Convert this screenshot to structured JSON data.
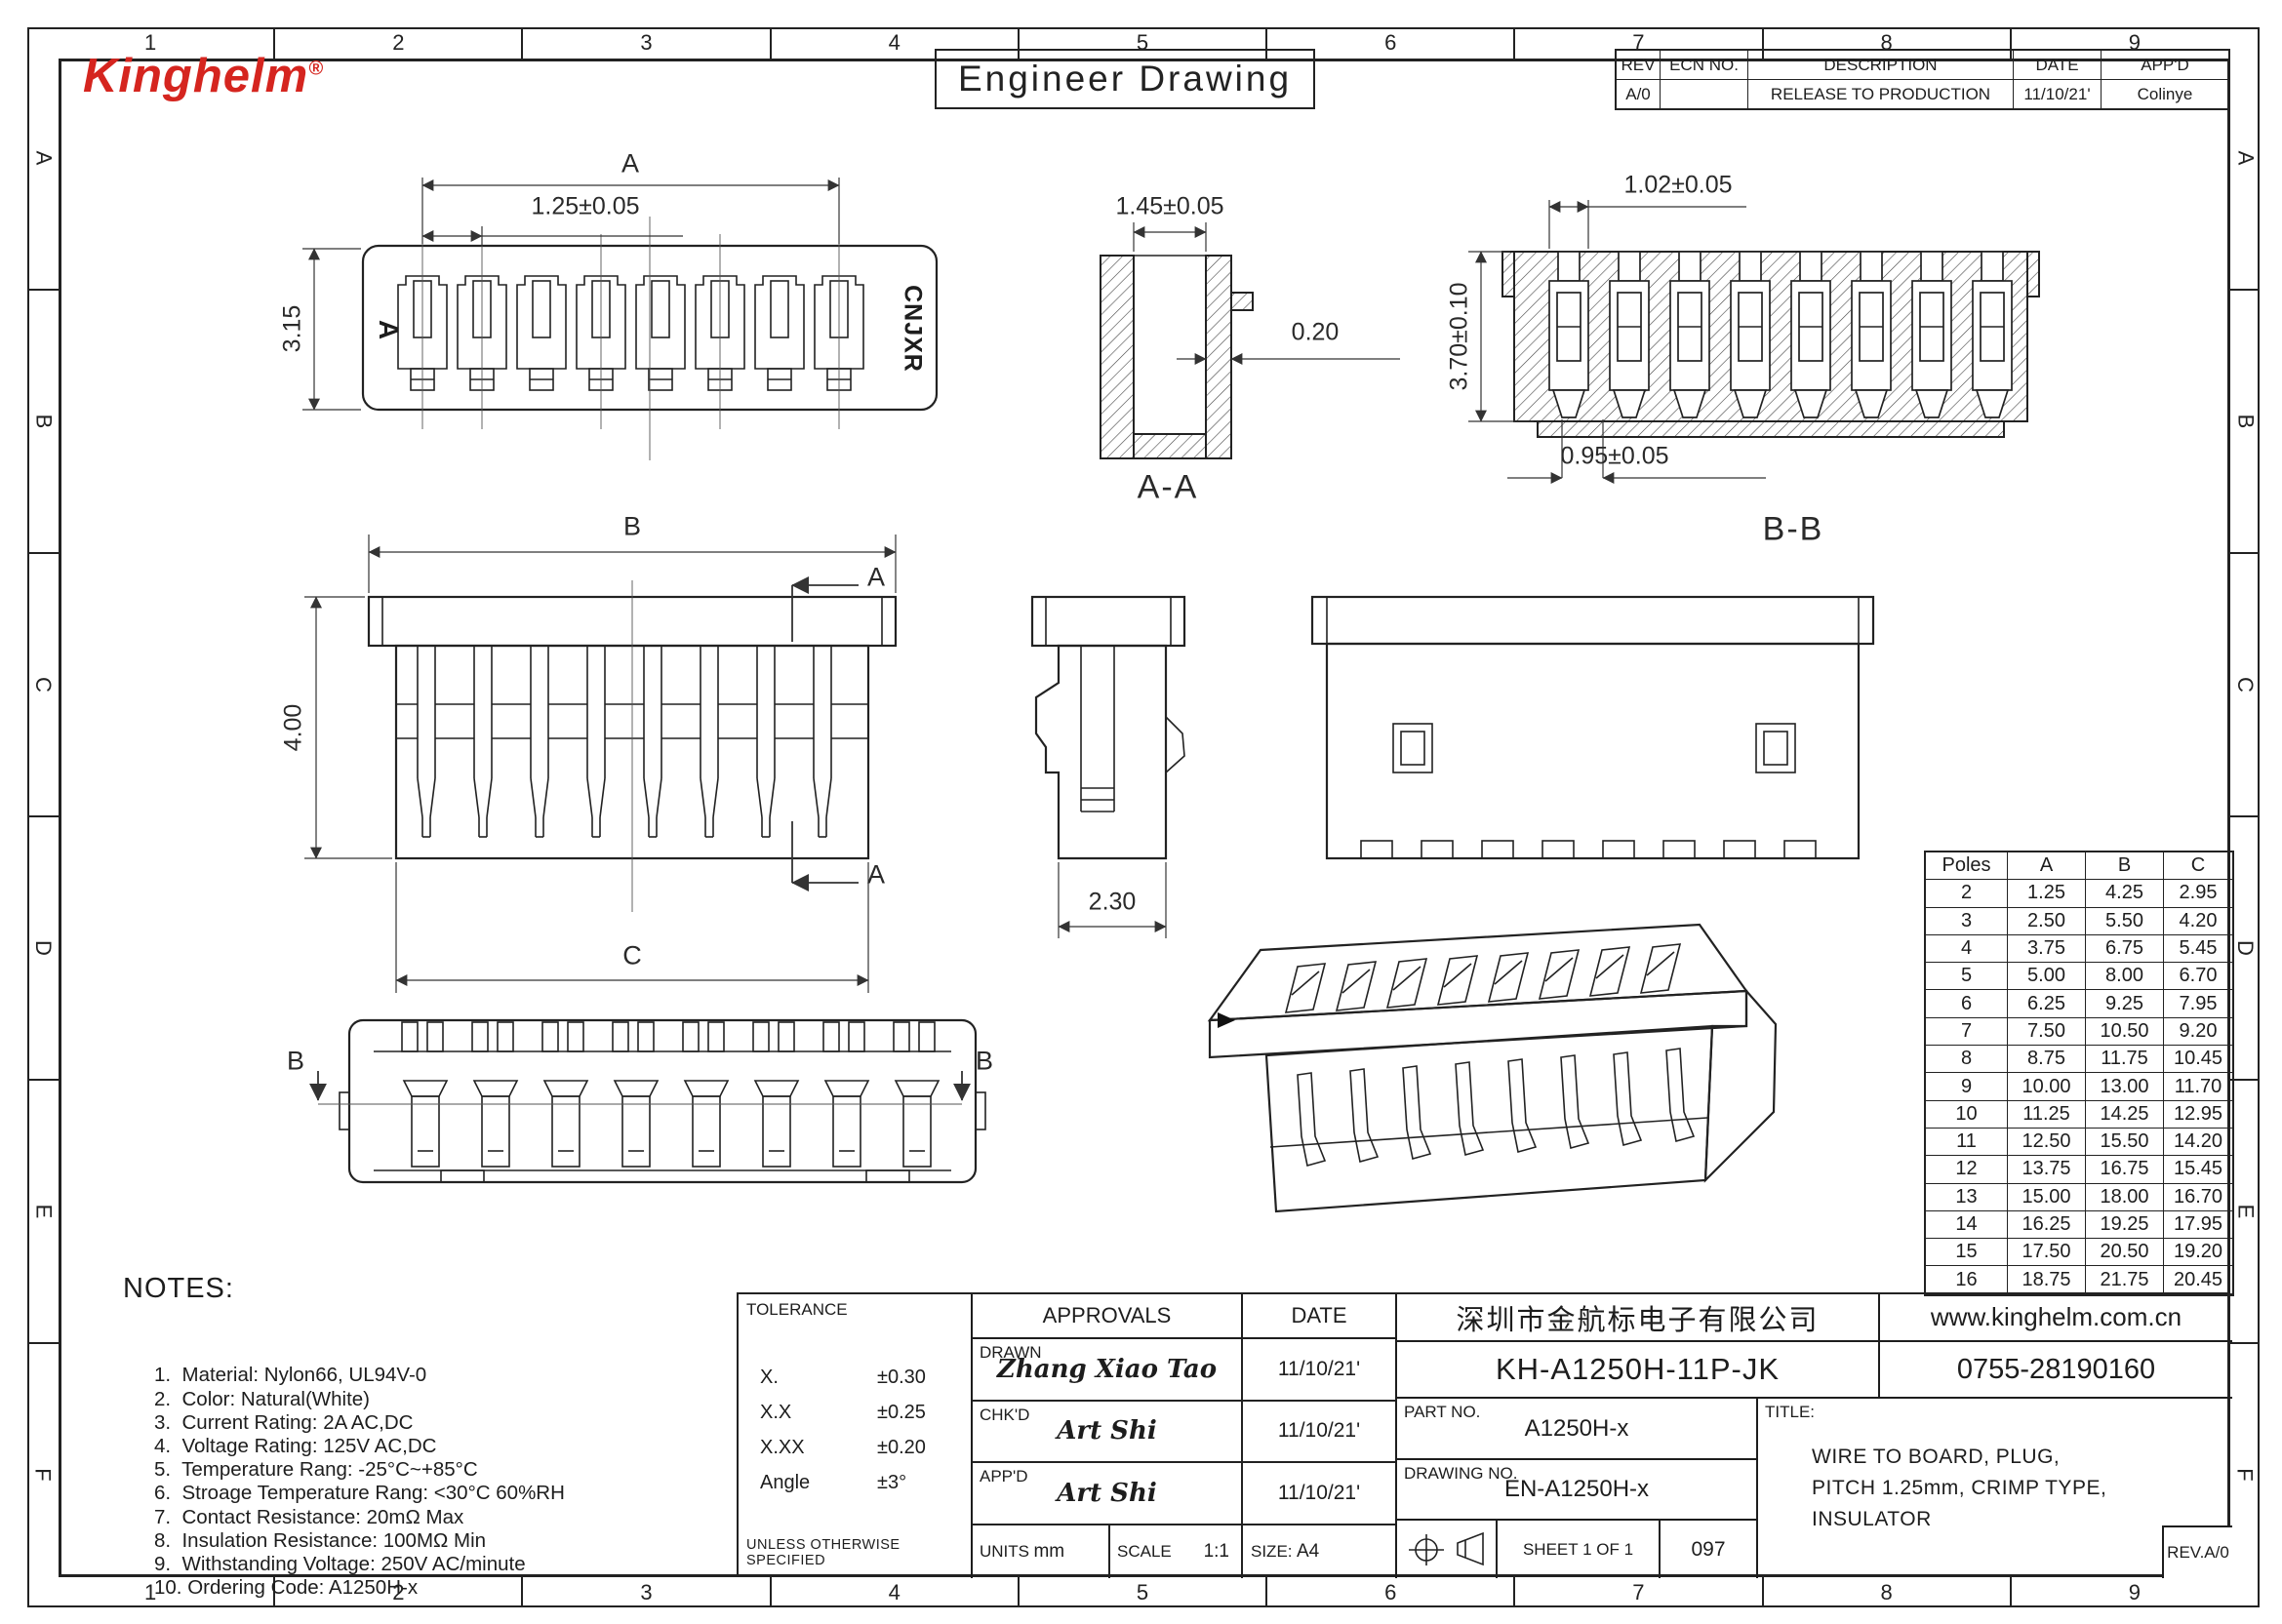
{
  "page": {
    "logo_text": "Kinghelm",
    "logo_reg": "®",
    "logo_color": "#d5251f",
    "sheet_title": "Engineer Drawing"
  },
  "border": {
    "columns": [
      "1",
      "2",
      "3",
      "4",
      "5",
      "6",
      "7",
      "8",
      "9"
    ],
    "rows": [
      "A",
      "B",
      "C",
      "D",
      "E",
      "F"
    ]
  },
  "revision_table": {
    "headers": [
      "REV",
      "ECN NO.",
      "DESCRIPTION",
      "DATE",
      "APP'D"
    ],
    "rows": [
      {
        "rev": "A/0",
        "ecn": "",
        "description": "RELEASE TO PRODUCTION",
        "date": "11/10/21'",
        "appd": "Colinye"
      }
    ]
  },
  "views": {
    "top_view": {
      "marking": "A",
      "side_text": "CNJXR",
      "dim_overall": "A",
      "dim_pitch": "1.25±0.05",
      "dim_height": "3.15"
    },
    "section_aa": {
      "label": "A-A",
      "dim_width": "1.45±0.05",
      "dim_wall": "0.20"
    },
    "section_bb": {
      "label": "B-B",
      "dim_slot": "1.02±0.05",
      "dim_height": "3.70±0.10",
      "dim_bottom": "0.95±0.05"
    },
    "front_view": {
      "dim_b": "B",
      "dim_height": "4.00",
      "dim_c": "C",
      "cut_label_top": "A",
      "cut_label_bottom": "A"
    },
    "side_view": {
      "dim_width": "2.30"
    },
    "bottom_view": {
      "cut_label_left": "B",
      "cut_label_right": "B"
    }
  },
  "poles_table": {
    "headers": [
      "Poles",
      "A",
      "B",
      "C"
    ],
    "rows": [
      [
        "2",
        "1.25",
        "4.25",
        "2.95"
      ],
      [
        "3",
        "2.50",
        "5.50",
        "4.20"
      ],
      [
        "4",
        "3.75",
        "6.75",
        "5.45"
      ],
      [
        "5",
        "5.00",
        "8.00",
        "6.70"
      ],
      [
        "6",
        "6.25",
        "9.25",
        "7.95"
      ],
      [
        "7",
        "7.50",
        "10.50",
        "9.20"
      ],
      [
        "8",
        "8.75",
        "11.75",
        "10.45"
      ],
      [
        "9",
        "10.00",
        "13.00",
        "11.70"
      ],
      [
        "10",
        "11.25",
        "14.25",
        "12.95"
      ],
      [
        "11",
        "12.50",
        "15.50",
        "14.20"
      ],
      [
        "12",
        "13.75",
        "16.75",
        "15.45"
      ],
      [
        "13",
        "15.00",
        "18.00",
        "16.70"
      ],
      [
        "14",
        "16.25",
        "19.25",
        "17.95"
      ],
      [
        "15",
        "17.50",
        "20.50",
        "19.20"
      ],
      [
        "16",
        "18.75",
        "21.75",
        "20.45"
      ]
    ]
  },
  "notes": {
    "title": "NOTES:",
    "items": [
      "1.  Material: Nylon66, UL94V-0",
      "2.  Color: Natural(White)",
      "3.  Current Rating: 2A AC,DC",
      "4.  Voltage Rating: 125V AC,DC",
      "5.  Temperature Rang: -25°C~+85°C",
      "6.  Stroage Temperature Rang: <30°C 60%RH",
      "7.  Contact Resistance: 20mΩ Max",
      "8.  Insulation Resistance: 100MΩ Min",
      "9.  Withstanding Voltage: 250V AC/minute",
      "10. Ordering Code: A1250H-x"
    ]
  },
  "title_block": {
    "tolerance": {
      "title": "TOLERANCE",
      "rows": [
        [
          "X.",
          "±0.30"
        ],
        [
          "X.X",
          "±0.25"
        ],
        [
          "X.XX",
          "±0.20"
        ],
        [
          "Angle",
          "±3°"
        ]
      ],
      "footnote": "UNLESS OTHERWISE SPECIFIED"
    },
    "approvals": {
      "header": "APPROVALS",
      "date_header": "DATE",
      "rows": [
        {
          "role": "DRAWN",
          "signature": "Zhang Xiao Tao",
          "date": "11/10/21'"
        },
        {
          "role": "CHK'D",
          "signature": "Art Shi",
          "date": "11/10/21'"
        },
        {
          "role": "APP'D",
          "signature": "Art Shi",
          "date": "11/10/21'"
        }
      ]
    },
    "units_label": "UNITS",
    "units_value": "mm",
    "scale_label": "SCALE",
    "scale_value": "1:1",
    "size_label": "SIZE:",
    "size_value": "A4",
    "company_cn": "深圳市金航标电子有限公司",
    "website": "www.kinghelm.com.cn",
    "part_code": "KH-A1250H-11P-JK",
    "phone": "0755-28190160",
    "part_no_label": "PART NO.",
    "part_no": "A1250H-x",
    "drawing_no_label": "DRAWING NO.",
    "drawing_no": "EN-A1250H-x",
    "title_label": "TITLE:",
    "title_lines": [
      "WIRE TO BOARD, PLUG,",
      "PITCH 1.25mm, CRIMP TYPE,",
      "INSULATOR"
    ],
    "sheet": "SHEET 1 OF 1",
    "doc_num": "097",
    "rev": "REV.A/0"
  }
}
